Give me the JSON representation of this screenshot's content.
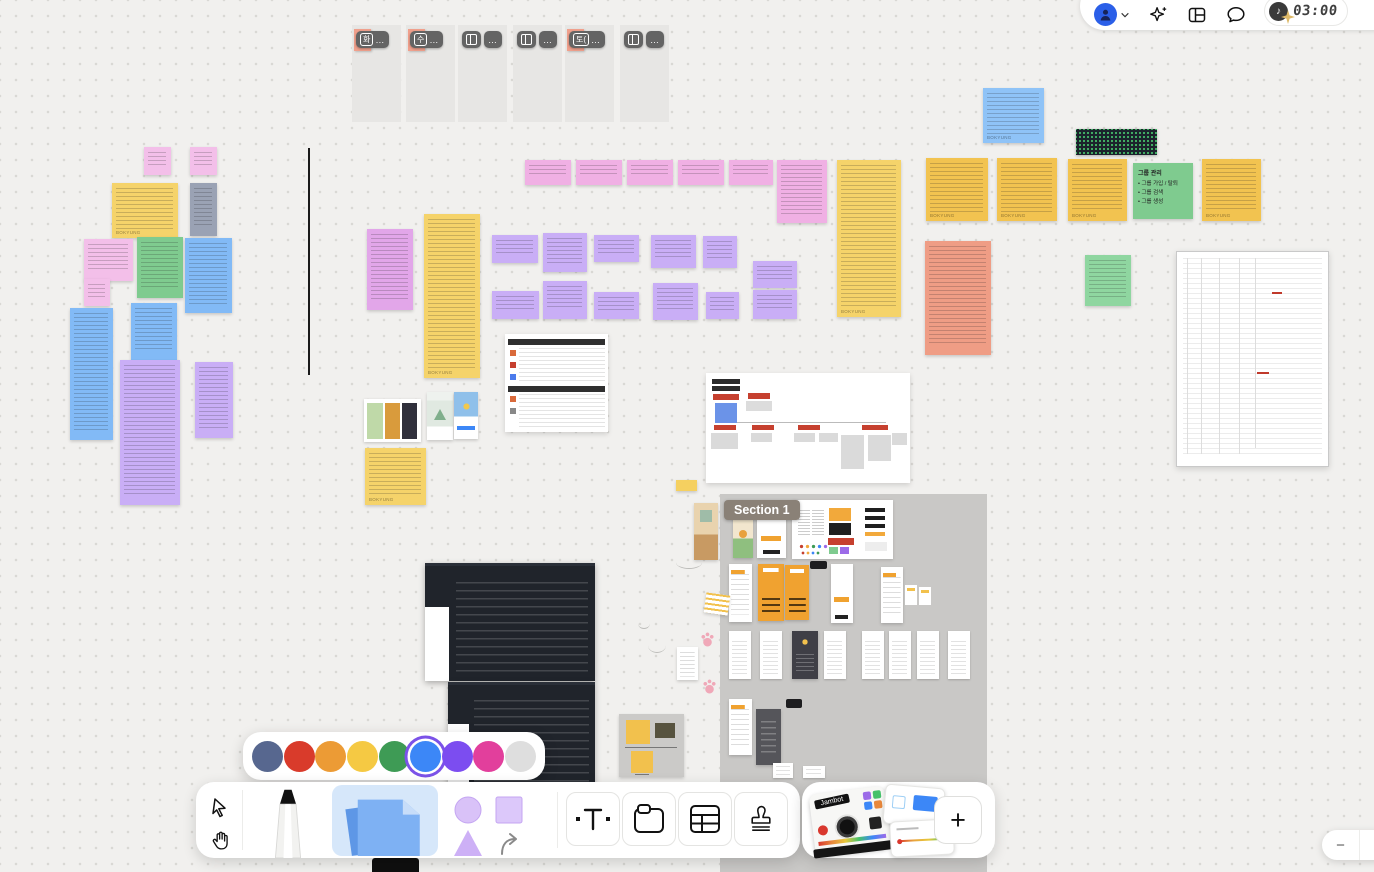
{
  "header": {
    "timer": "03:00",
    "accent_blue": "#2B5FE8"
  },
  "tabs": {
    "overflow": "…",
    "items": [
      {
        "x": 352,
        "label": "화",
        "sticky": true
      },
      {
        "x": 406,
        "label": "수",
        "sticky": true
      },
      {
        "x": 458,
        "icon": "layout-columns",
        "sticky": false
      },
      {
        "x": 513,
        "icon": "layout-columns",
        "sticky": false
      },
      {
        "x": 565,
        "label": "토(",
        "sticky": true
      },
      {
        "x": 620,
        "icon": "layout-columns",
        "sticky": false
      }
    ]
  },
  "section": {
    "label": "Section 1"
  },
  "color_picker": {
    "selected_index": 5,
    "colors": [
      "#57678F",
      "#D93B2B",
      "#EC9B35",
      "#F5C943",
      "#3E9B55",
      "#3C87F7",
      "#7C4DF0",
      "#E23F9C",
      "#DEDEDE"
    ],
    "selection_ring": "#7B52E8"
  },
  "toolbar": {
    "tools": [
      "select",
      "hand",
      "marker",
      "sticky-note",
      "shape",
      "text",
      "section",
      "table",
      "stamp"
    ]
  },
  "widgets": {
    "jambot_label": "Jambot",
    "plus_label": "+"
  },
  "zoom_control": {
    "minus_label": "−"
  },
  "board": {
    "signature": "BOKYUNG",
    "note_palette": {
      "pink": "#F3BFE9",
      "magenta": "#F0B0E4",
      "yellow": "#F5D36A",
      "orange_yellow": "#F2C350",
      "green": "#7FCB8F",
      "light_green": "#8FD6A0",
      "blue": "#82BAF6",
      "light_blue": "#8FC3F7",
      "purple": "#C9AEF6",
      "violet": "#E2A6E9",
      "gray_blue": "#9AA2B4",
      "salmon": "#EF9D85"
    },
    "items": [
      {
        "t": "section",
        "nm": "section-area",
        "x": 720,
        "y": 494,
        "w": 267,
        "h": 378
      },
      {
        "t": "phone-cat",
        "nm": "mobile-mockup",
        "x": 733,
        "y": 509,
        "w": 20,
        "h": 49
      },
      {
        "t": "phone-plain",
        "nm": "mobile-mockup",
        "x": 757,
        "y": 508,
        "w": 29,
        "h": 50
      },
      {
        "t": "styleguide",
        "nm": "style-guide-card",
        "x": 792,
        "y": 500,
        "w": 101,
        "h": 59
      },
      {
        "t": "phone-rows",
        "nm": "mobile-mockup",
        "x": 729,
        "y": 564,
        "w": 23,
        "h": 58
      },
      {
        "t": "phone-orange",
        "nm": "mobile-mockup",
        "x": 758,
        "y": 564,
        "w": 26,
        "h": 57
      },
      {
        "t": "phone-orange",
        "nm": "mobile-mockup",
        "x": 785,
        "y": 565,
        "w": 24,
        "h": 55
      },
      {
        "t": "black-pill",
        "nm": "label-chip",
        "x": 810,
        "y": 561,
        "w": 17,
        "h": 8
      },
      {
        "t": "phone-plain",
        "nm": "mobile-mockup",
        "x": 831,
        "y": 564,
        "w": 22,
        "h": 59
      },
      {
        "t": "phone-rows",
        "nm": "mobile-mockup",
        "x": 881,
        "y": 567,
        "w": 22,
        "h": 56
      },
      {
        "t": "mini-cards",
        "nm": "mini-cards",
        "x": 905,
        "y": 585,
        "w": 28,
        "h": 22
      },
      {
        "t": "phone-mini",
        "nm": "mobile-mockup",
        "x": 729,
        "y": 631,
        "w": 22,
        "h": 48
      },
      {
        "t": "phone-mini",
        "nm": "mobile-mockup",
        "x": 760,
        "y": 631,
        "w": 22,
        "h": 48
      },
      {
        "t": "phone-dark",
        "nm": "mobile-mockup",
        "x": 792,
        "y": 631,
        "w": 26,
        "h": 48
      },
      {
        "t": "phone-mini",
        "nm": "mobile-mockup",
        "x": 824,
        "y": 631,
        "w": 22,
        "h": 48
      },
      {
        "t": "phone-mini",
        "nm": "mobile-mockup",
        "x": 862,
        "y": 631,
        "w": 22,
        "h": 48
      },
      {
        "t": "phone-mini",
        "nm": "mobile-mockup",
        "x": 889,
        "y": 631,
        "w": 22,
        "h": 48
      },
      {
        "t": "phone-mini",
        "nm": "mobile-mockup",
        "x": 917,
        "y": 631,
        "w": 22,
        "h": 48
      },
      {
        "t": "phone-mini",
        "nm": "mobile-mockup",
        "x": 948,
        "y": 631,
        "w": 22,
        "h": 48
      },
      {
        "t": "phone-rows",
        "nm": "mobile-mockup",
        "x": 729,
        "y": 699,
        "w": 23,
        "h": 56
      },
      {
        "t": "phone-darkgray",
        "nm": "mobile-mockup",
        "x": 756,
        "y": 709,
        "w": 25,
        "h": 56
      },
      {
        "t": "black-pill",
        "nm": "label-chip",
        "x": 786,
        "y": 699,
        "w": 16,
        "h": 9
      },
      {
        "t": "phone-mini",
        "nm": "mobile-mockup",
        "x": 773,
        "y": 763,
        "w": 20,
        "h": 15
      },
      {
        "t": "phone-mini",
        "nm": "mobile-mockup",
        "x": 803,
        "y": 766,
        "w": 22,
        "h": 12
      },
      {
        "x": 144,
        "y": 147,
        "w": 27,
        "h": 28,
        "bg": "#F3BFE9",
        "ln": 1
      },
      {
        "x": 190,
        "y": 147,
        "w": 27,
        "h": 28,
        "bg": "#F3BFE9",
        "ln": 1
      },
      {
        "x": 112,
        "y": 183,
        "w": 66,
        "h": 55,
        "bg": "#F5D36A",
        "ln": 1,
        "sig": 1
      },
      {
        "x": 190,
        "y": 183,
        "w": 27,
        "h": 53,
        "bg": "#9AA2B4",
        "ln": 1
      },
      {
        "x": 84,
        "y": 239,
        "w": 49,
        "h": 42,
        "bg": "#F3BFE9",
        "ln": 1
      },
      {
        "x": 84,
        "y": 279,
        "w": 26,
        "h": 27,
        "bg": "#F3BFE9",
        "ln": 1
      },
      {
        "x": 137,
        "y": 237,
        "w": 46,
        "h": 61,
        "bg": "#7FCB8F",
        "ln": 1
      },
      {
        "x": 185,
        "y": 238,
        "w": 47,
        "h": 75,
        "bg": "#82BAF6",
        "ln": 1
      },
      {
        "x": 70,
        "y": 308,
        "w": 43,
        "h": 132,
        "bg": "#82BAF6",
        "ln": 1
      },
      {
        "x": 131,
        "y": 303,
        "w": 46,
        "h": 58,
        "bg": "#82BAF6",
        "ln": 1
      },
      {
        "x": 120,
        "y": 360,
        "w": 60,
        "h": 145,
        "bg": "#C9AEF6",
        "ln": 1
      },
      {
        "x": 195,
        "y": 362,
        "w": 38,
        "h": 76,
        "bg": "#C9AEF6",
        "ln": 1
      },
      {
        "t": "vline",
        "nm": "drawn-line",
        "x": 308,
        "y": 148,
        "w": 2,
        "h": 227
      },
      {
        "x": 525,
        "y": 160,
        "w": 46,
        "h": 25,
        "bg": "#F0B0E4",
        "ln": 1
      },
      {
        "x": 576,
        "y": 160,
        "w": 46,
        "h": 25,
        "bg": "#F0B0E4",
        "ln": 1
      },
      {
        "x": 627,
        "y": 160,
        "w": 46,
        "h": 25,
        "bg": "#F0B0E4",
        "ln": 1
      },
      {
        "x": 678,
        "y": 160,
        "w": 46,
        "h": 25,
        "bg": "#F0B0E4",
        "ln": 1
      },
      {
        "x": 729,
        "y": 160,
        "w": 44,
        "h": 25,
        "bg": "#F0B0E4",
        "ln": 1
      },
      {
        "x": 777,
        "y": 160,
        "w": 50,
        "h": 63,
        "bg": "#F0B0E4",
        "ln": 1
      },
      {
        "x": 837,
        "y": 160,
        "w": 64,
        "h": 157,
        "bg": "#F5D36A",
        "ln": 1,
        "sig": 1
      },
      {
        "x": 367,
        "y": 229,
        "w": 46,
        "h": 81,
        "bg": "#E2A6E9",
        "ln": 1
      },
      {
        "x": 424,
        "y": 214,
        "w": 56,
        "h": 164,
        "bg": "#F5D36A",
        "ln": 1,
        "sig": 1
      },
      {
        "x": 492,
        "y": 235,
        "w": 46,
        "h": 28,
        "bg": "#C9AEF6",
        "ln": 1
      },
      {
        "x": 543,
        "y": 233,
        "w": 44,
        "h": 39,
        "bg": "#C9AEF6",
        "ln": 1
      },
      {
        "x": 594,
        "y": 235,
        "w": 45,
        "h": 27,
        "bg": "#C9AEF6",
        "ln": 1
      },
      {
        "x": 651,
        "y": 235,
        "w": 45,
        "h": 33,
        "bg": "#C9AEF6",
        "ln": 1
      },
      {
        "x": 703,
        "y": 236,
        "w": 34,
        "h": 32,
        "bg": "#C9AEF6",
        "ln": 1
      },
      {
        "x": 753,
        "y": 261,
        "w": 44,
        "h": 27,
        "bg": "#C9AEF6",
        "ln": 1
      },
      {
        "x": 492,
        "y": 291,
        "w": 47,
        "h": 28,
        "bg": "#C9AEF6",
        "ln": 1
      },
      {
        "x": 543,
        "y": 281,
        "w": 44,
        "h": 38,
        "bg": "#C9AEF6",
        "ln": 1
      },
      {
        "x": 594,
        "y": 292,
        "w": 45,
        "h": 27,
        "bg": "#C9AEF6",
        "ln": 1
      },
      {
        "x": 653,
        "y": 283,
        "w": 45,
        "h": 37,
        "bg": "#C9AEF6",
        "ln": 1
      },
      {
        "x": 706,
        "y": 292,
        "w": 33,
        "h": 27,
        "bg": "#C9AEF6",
        "ln": 1
      },
      {
        "x": 753,
        "y": 290,
        "w": 44,
        "h": 29,
        "bg": "#C9AEF6",
        "ln": 1
      },
      {
        "x": 983,
        "y": 88,
        "w": 61,
        "h": 55,
        "bg": "#8FC3F7",
        "ln": 1,
        "sig": 1
      },
      {
        "t": "gh-graph",
        "nm": "github-graph-image",
        "x": 1076,
        "y": 129,
        "w": 81,
        "h": 26
      },
      {
        "x": 926,
        "y": 158,
        "w": 62,
        "h": 63,
        "bg": "#F2C350",
        "ln": 1,
        "sig": 1
      },
      {
        "x": 997,
        "y": 158,
        "w": 60,
        "h": 63,
        "bg": "#F2C350",
        "ln": 1,
        "sig": 1
      },
      {
        "x": 1068,
        "y": 159,
        "w": 59,
        "h": 62,
        "bg": "#F2C350",
        "ln": 1,
        "sig": 1
      },
      {
        "nm": "group-note",
        "x": 1133,
        "y": 163,
        "w": 60,
        "h": 56,
        "bg": "#7FCB8F",
        "ti": "그룹 관리",
        "bu": [
          "그룹 가입 / 탈퇴",
          "그룹 검색",
          "그룹 생성"
        ]
      },
      {
        "x": 1202,
        "y": 159,
        "w": 59,
        "h": 62,
        "bg": "#F2C350",
        "ln": 1,
        "sig": 1
      },
      {
        "x": 925,
        "y": 241,
        "w": 66,
        "h": 114,
        "bg": "#EF9D85",
        "ln": 1
      },
      {
        "x": 1085,
        "y": 255,
        "w": 46,
        "h": 51,
        "bg": "#8FD6A0",
        "ln": 1
      },
      {
        "t": "doc-table",
        "nm": "spec-document-page",
        "x": 1176,
        "y": 251,
        "w": 151,
        "h": 214
      },
      {
        "t": "table-shot",
        "nm": "comparison-table-screenshot",
        "x": 505,
        "y": 334,
        "w": 103,
        "h": 98
      },
      {
        "t": "cute-phones",
        "nm": "app-screenshots",
        "x": 364,
        "y": 399,
        "w": 57,
        "h": 43
      },
      {
        "t": "phone-mountain",
        "nm": "app-screenshot",
        "x": 427,
        "y": 392,
        "w": 26,
        "h": 48
      },
      {
        "t": "phone-piggy",
        "nm": "app-screenshot",
        "x": 454,
        "y": 392,
        "w": 24,
        "h": 47
      },
      {
        "x": 365,
        "y": 448,
        "w": 61,
        "h": 57,
        "bg": "#F5D36A",
        "ln": 1,
        "sig": 1
      },
      {
        "t": "flowchart",
        "nm": "ia-flowchart-image",
        "x": 706,
        "y": 373,
        "w": 204,
        "h": 110
      },
      {
        "t": "dark-shot",
        "nm": "app-dark-screenshot",
        "x": 425,
        "y": 563,
        "w": 170,
        "h": 115
      },
      {
        "t": "dark-shot",
        "nm": "app-dark-screenshot",
        "x": 448,
        "y": 682,
        "w": 147,
        "h": 108
      },
      {
        "t": "cat-room",
        "nm": "illustration-image",
        "x": 694,
        "y": 503,
        "w": 24,
        "h": 57
      },
      {
        "x": 676,
        "y": 480,
        "w": 21,
        "h": 11,
        "bg": "#F5D060"
      },
      {
        "t": "notepad",
        "nm": "sticker-image",
        "x": 705,
        "y": 594,
        "w": 24,
        "h": 20
      },
      {
        "t": "scribble",
        "nm": "pen-scribble",
        "x": 676,
        "y": 556,
        "w": 26,
        "h": 12
      },
      {
        "t": "scribble",
        "nm": "pen-scribble",
        "x": 638,
        "y": 618,
        "w": 12,
        "h": 10
      },
      {
        "t": "scribble",
        "nm": "pen-scribble",
        "x": 648,
        "y": 638,
        "w": 18,
        "h": 14
      },
      {
        "t": "mini-note",
        "nm": "mini-note",
        "x": 677,
        "y": 647,
        "w": 21,
        "h": 33
      },
      {
        "t": "paw",
        "nm": "paw-stamp",
        "x": 700,
        "y": 632,
        "w": 15,
        "h": 15
      },
      {
        "t": "paw",
        "nm": "paw-stamp",
        "x": 702,
        "y": 679,
        "w": 15,
        "h": 15
      },
      {
        "t": "meme-card",
        "nm": "meme-stickers-card",
        "x": 619,
        "y": 714,
        "w": 65,
        "h": 63
      }
    ]
  }
}
